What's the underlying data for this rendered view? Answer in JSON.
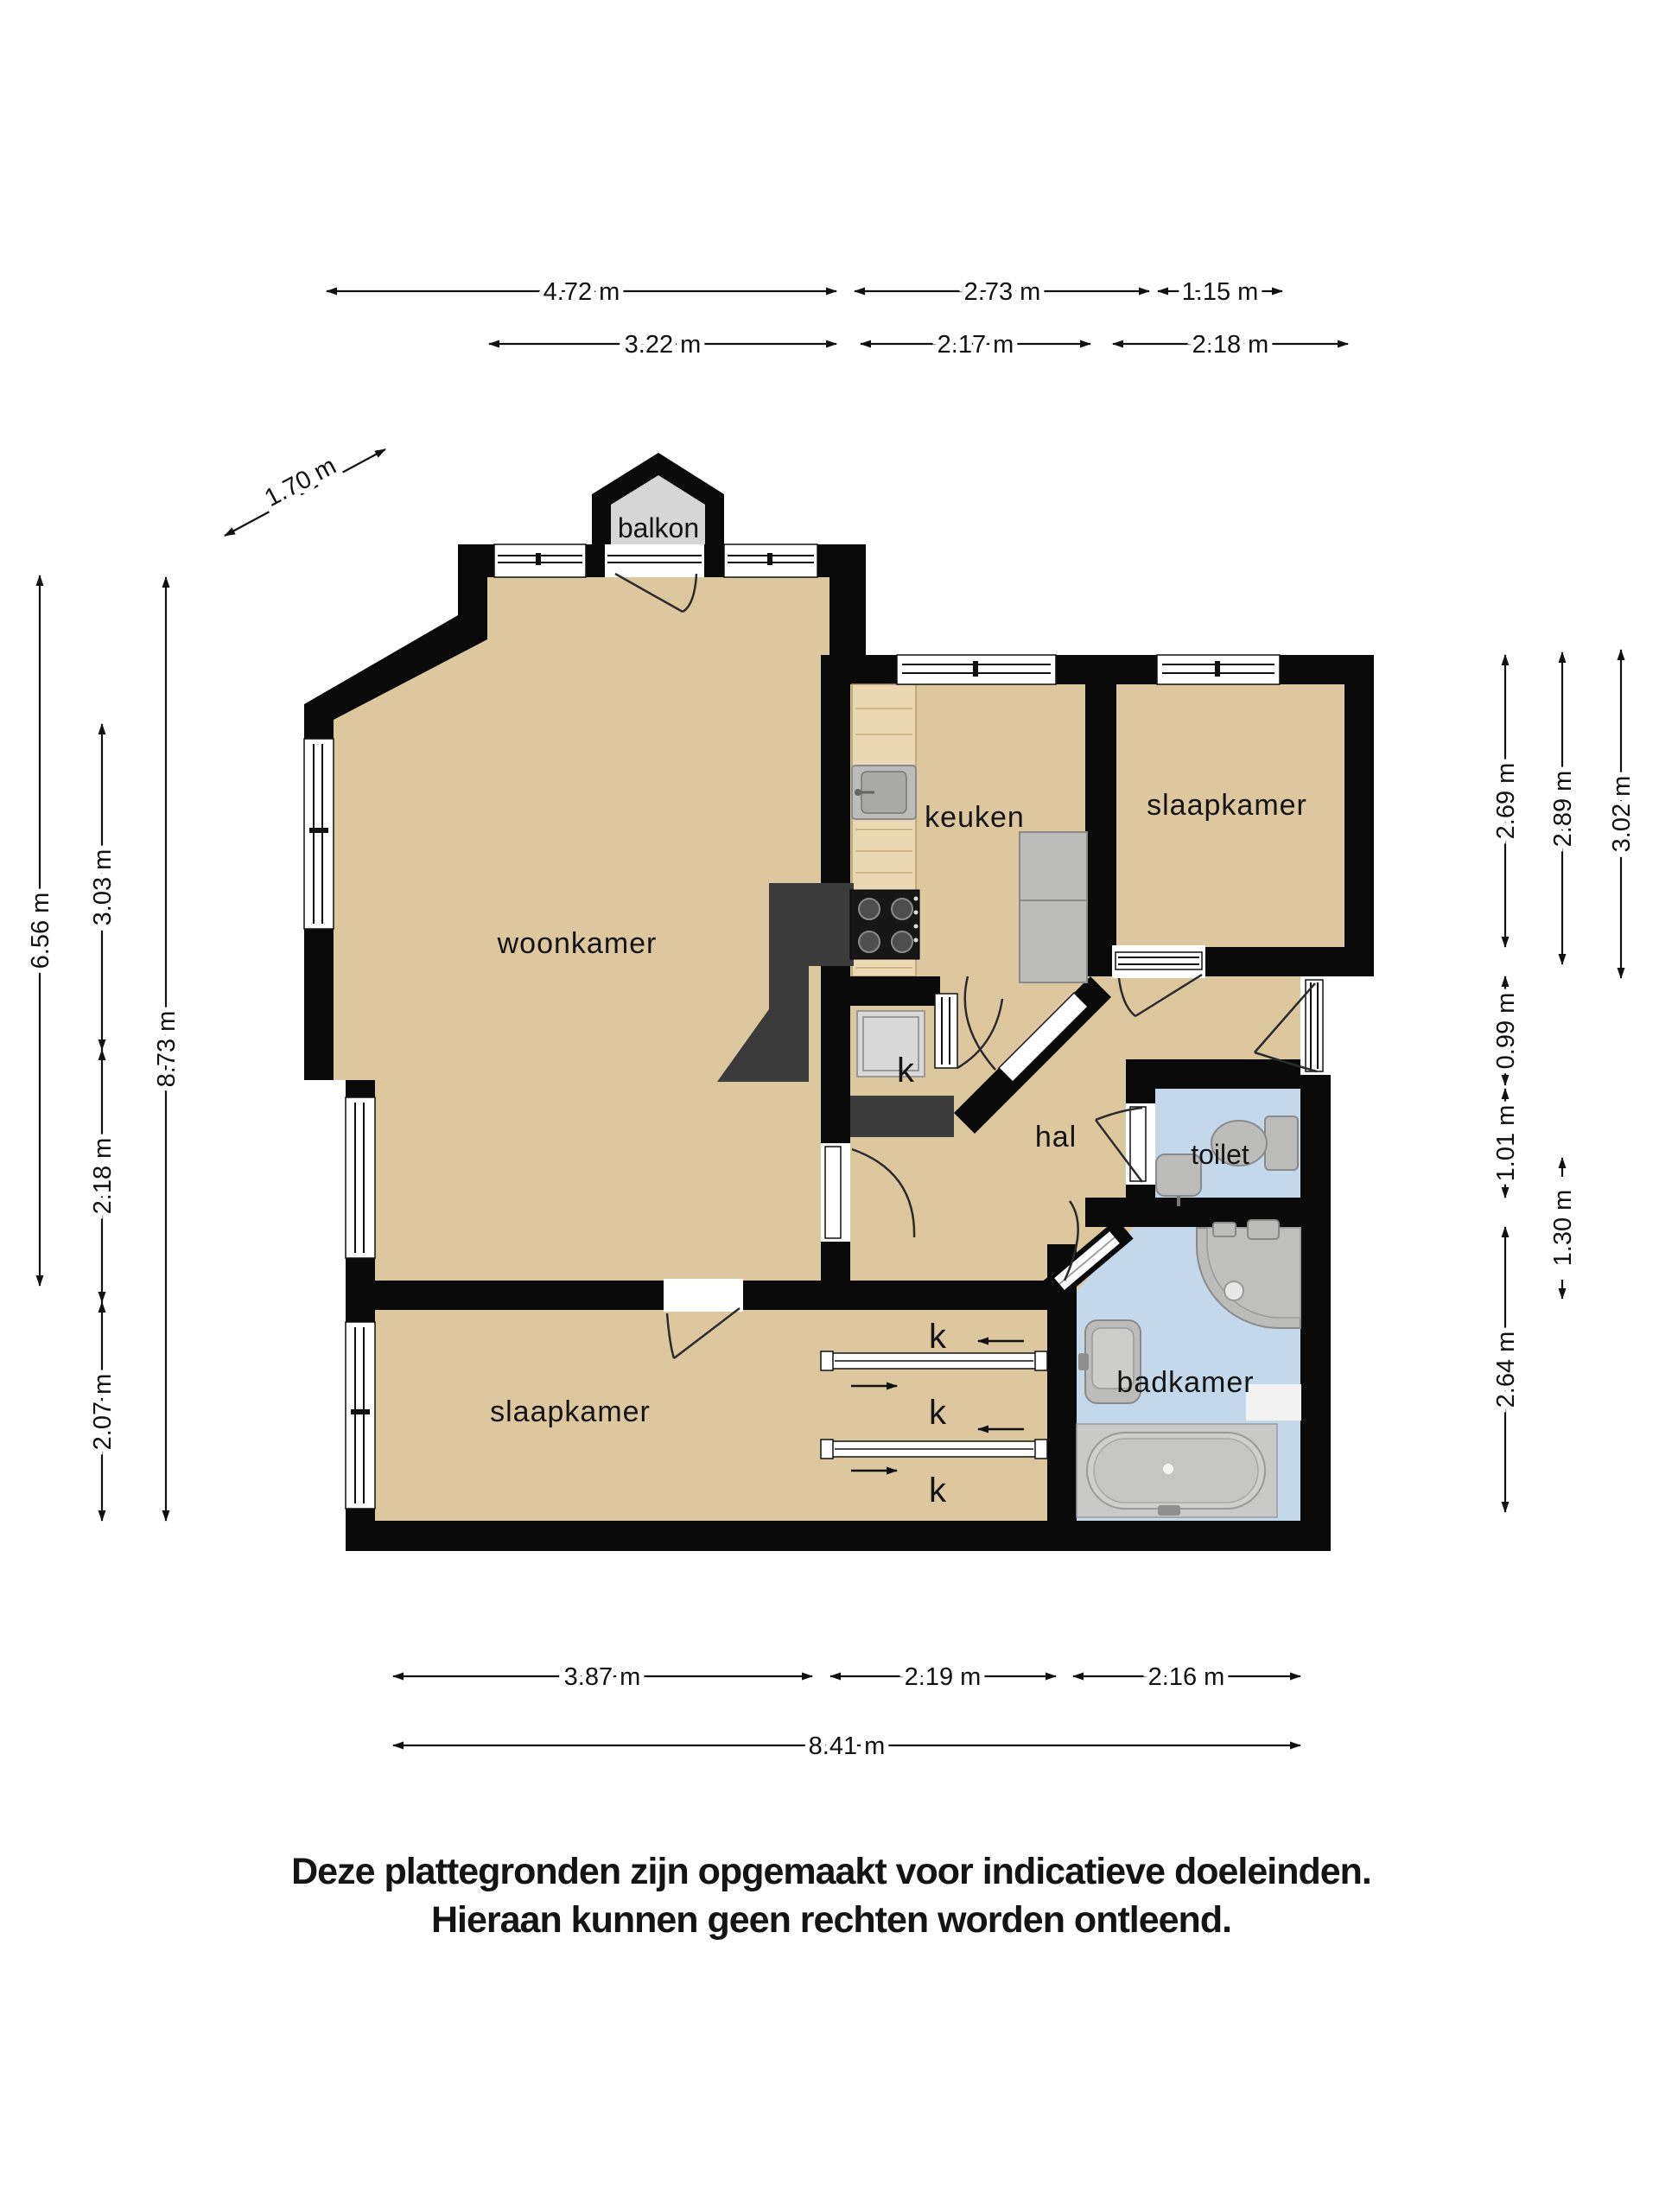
{
  "rooms": [
    {
      "id": "balkon",
      "label": "balkon"
    },
    {
      "id": "woonkamer",
      "label": "woonkamer"
    },
    {
      "id": "keuken",
      "label": "keuken"
    },
    {
      "id": "slaapkamer-top",
      "label": "slaapkamer"
    },
    {
      "id": "hal",
      "label": "hal"
    },
    {
      "id": "toilet",
      "label": "toilet"
    },
    {
      "id": "badkamer",
      "label": "badkamer"
    },
    {
      "id": "slaapkamer-bottom",
      "label": "slaapkamer"
    },
    {
      "id": "kast-center",
      "label": "k"
    },
    {
      "id": "kast-1",
      "label": "k"
    },
    {
      "id": "kast-2",
      "label": "k"
    },
    {
      "id": "kast-3",
      "label": "k"
    }
  ],
  "dims": {
    "top_outer": [
      "4.72 m",
      "2.73 m",
      "1.15 m"
    ],
    "top_inner": [
      "3.22 m",
      "2.17 m",
      "2.18 m"
    ],
    "left": [
      "6.56 m",
      "3.03 m",
      "2.18 m",
      "2.07 m",
      "8.73 m"
    ],
    "right": [
      "2.69 m",
      "0.99 m",
      "1.01 m",
      "2.64 m",
      "2.89 m",
      "1.30 m",
      "3.02 m"
    ],
    "bottom_inner": [
      "3.87 m",
      "2.19 m",
      "2.16 m"
    ],
    "bottom_outer": [
      "8.41 m"
    ],
    "diagonal": [
      "1.70 m"
    ]
  },
  "disclaimer": {
    "line1": "Deze plattegronden zijn opgemaakt voor indicatieve doeleinden.",
    "line2": "Hieraan kunnen geen rechten worden ontleend."
  },
  "colors": {
    "wall": "#0a0a0a",
    "floor": "#dcc79e",
    "wet_floor": "#c3d8eb",
    "balcony_floor": "#d6d6d6",
    "counter_wood": "#e9d8b3",
    "fixture": "#bcbcba",
    "fixture_dark": "#3b3b3b",
    "background": "#ffffff",
    "text": "#141414"
  }
}
